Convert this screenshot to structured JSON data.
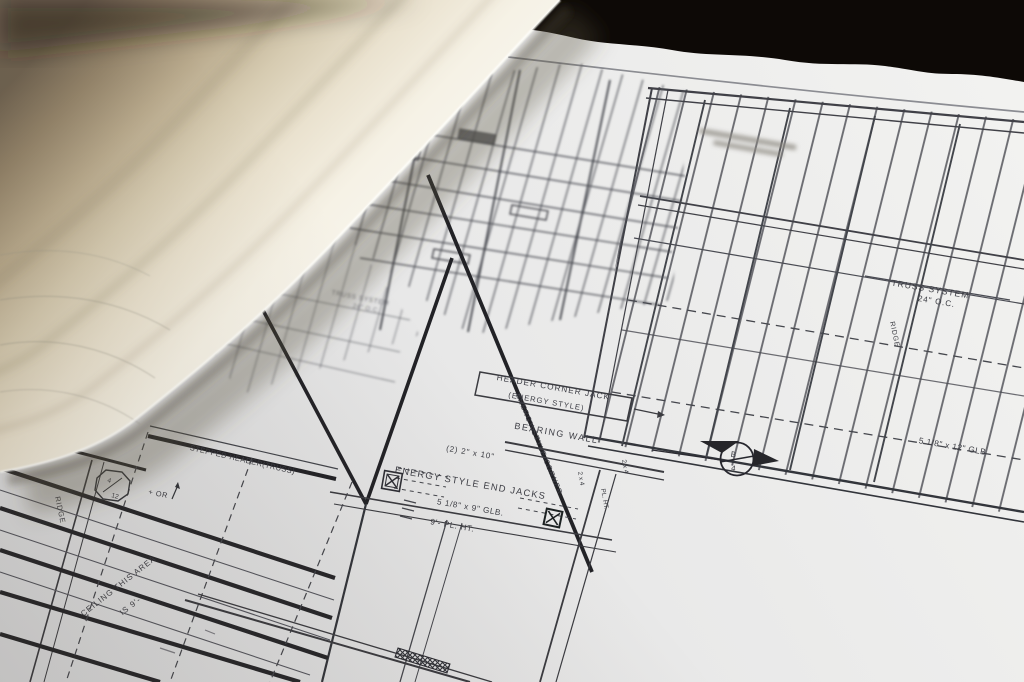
{
  "colors": {
    "backdrop": "#0d0906",
    "sheet_light": "#f1f1ef",
    "sheet_mid": "#e8e8e8",
    "sheet_dark": "#dededf",
    "roll_dark_tan": "#75664f",
    "roll_cream": "#f5f1e4",
    "ink": "#3c3d44",
    "ink_heavy": "#212227"
  },
  "annotations": {
    "header_corner_jack_1": "HEADER CORNER JACK",
    "header_corner_jack_2": "(ENERGY STYLE)",
    "bearing_wall": "BEARING WALL",
    "double_2x10": "(2) 2\" x 10\"",
    "energy_end_jacks": "ENERGY STYLE END JACKS",
    "glb_9": "5 1/8\" x 9\" GLB.",
    "pl_ht_9": "9'- PL. HT.",
    "energy_corner": "ENERGY STYLE CORNER",
    "stepped_header": "STEPPED HEADER(TRUSS)",
    "truss_system_r1": "TRUSS SYSTEM",
    "truss_system_r2": "24\" O.C.",
    "truss_system_l1": "TRUSS SYSTEM",
    "truss_system_l2": "24\" O.C.",
    "ridge_left": "RIDGE",
    "ridge_right": "RIDGE",
    "ceiling_1": "CEILING THIS AREA",
    "ceiling_2": "IS 9'-",
    "pitch_top": "4",
    "pitch_bottom": "12",
    "pitch_or": "+ OR",
    "glb_12": "5 1/8\" x 12\" GLB",
    "section_b": "B",
    "section_4": "4",
    "tag_2x4_a": "2 x 4",
    "tag_2x4_b": "2 x 4",
    "tag_pl_ht": "PL. HT."
  }
}
